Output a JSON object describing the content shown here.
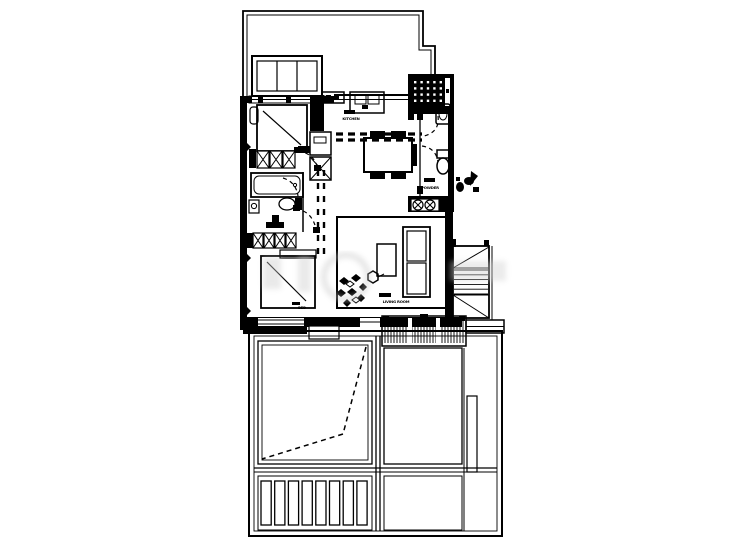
{
  "document": {
    "type": "architectural-floor-plan",
    "description": "Black-and-white apartment floor plan with lower terrace and deck"
  },
  "colors": {
    "ink": "#000000",
    "paper": "#ffffff",
    "watermark": "#cccccc"
  },
  "labels": {
    "kitchen": "KITCHEN",
    "powder": "POWDER",
    "living_room": "LIVING ROOM",
    "bedroom": "BED"
  },
  "features": {
    "bay_window_panes": 3,
    "closet_row_top_boxes": 3,
    "closet_row_bottom_boxes": 4,
    "entry_closet_circles": 2,
    "entry_mat_dot_rows": 4,
    "entry_mat_dot_cols": 5,
    "stair_treads": 6,
    "deck_hatch_spacing_px": 3,
    "terrace_louvers": 8
  }
}
